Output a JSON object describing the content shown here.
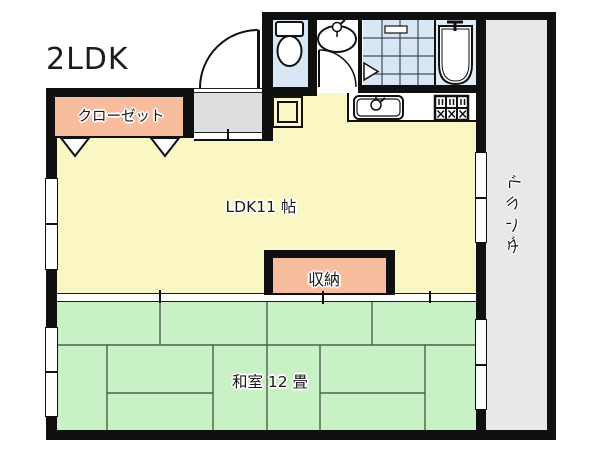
{
  "plan": {
    "type_label": "2LDK",
    "rooms": {
      "ldk": {
        "name": "LDK11 帖"
      },
      "japanese_room": {
        "name": "和室 12 畳"
      },
      "closet": {
        "name": "クローゼット"
      },
      "storage": {
        "name": "収納"
      },
      "veranda": {
        "name": "ベランダ",
        "chars": [
          "ベ",
          "ラ",
          "ン",
          "ダ"
        ]
      }
    },
    "icons": [
      "toilet-icon",
      "washbasin-icon",
      "bathtub-icon",
      "bathroom-tile",
      "kitchen-sink-icon",
      "stove-icon",
      "entrance-door-arc-icon",
      "washroom-door-arc-icon",
      "closet-door-triangle-icon",
      "sliding-window-icon",
      "shoe-cabinet-icon",
      "tatami-mats"
    ],
    "colors": {
      "ldk_fill": "#FBF7C4",
      "japanese_room_fill": "#C8F1C5",
      "closet_fill": "#F8BC9E",
      "storage_fill": "#F8BC9E",
      "veranda_fill": "#E8E8E8",
      "bathroom_fill": "#D9E7F4",
      "genkan_fill": "#DEDEDE",
      "wall": "#101010"
    }
  }
}
